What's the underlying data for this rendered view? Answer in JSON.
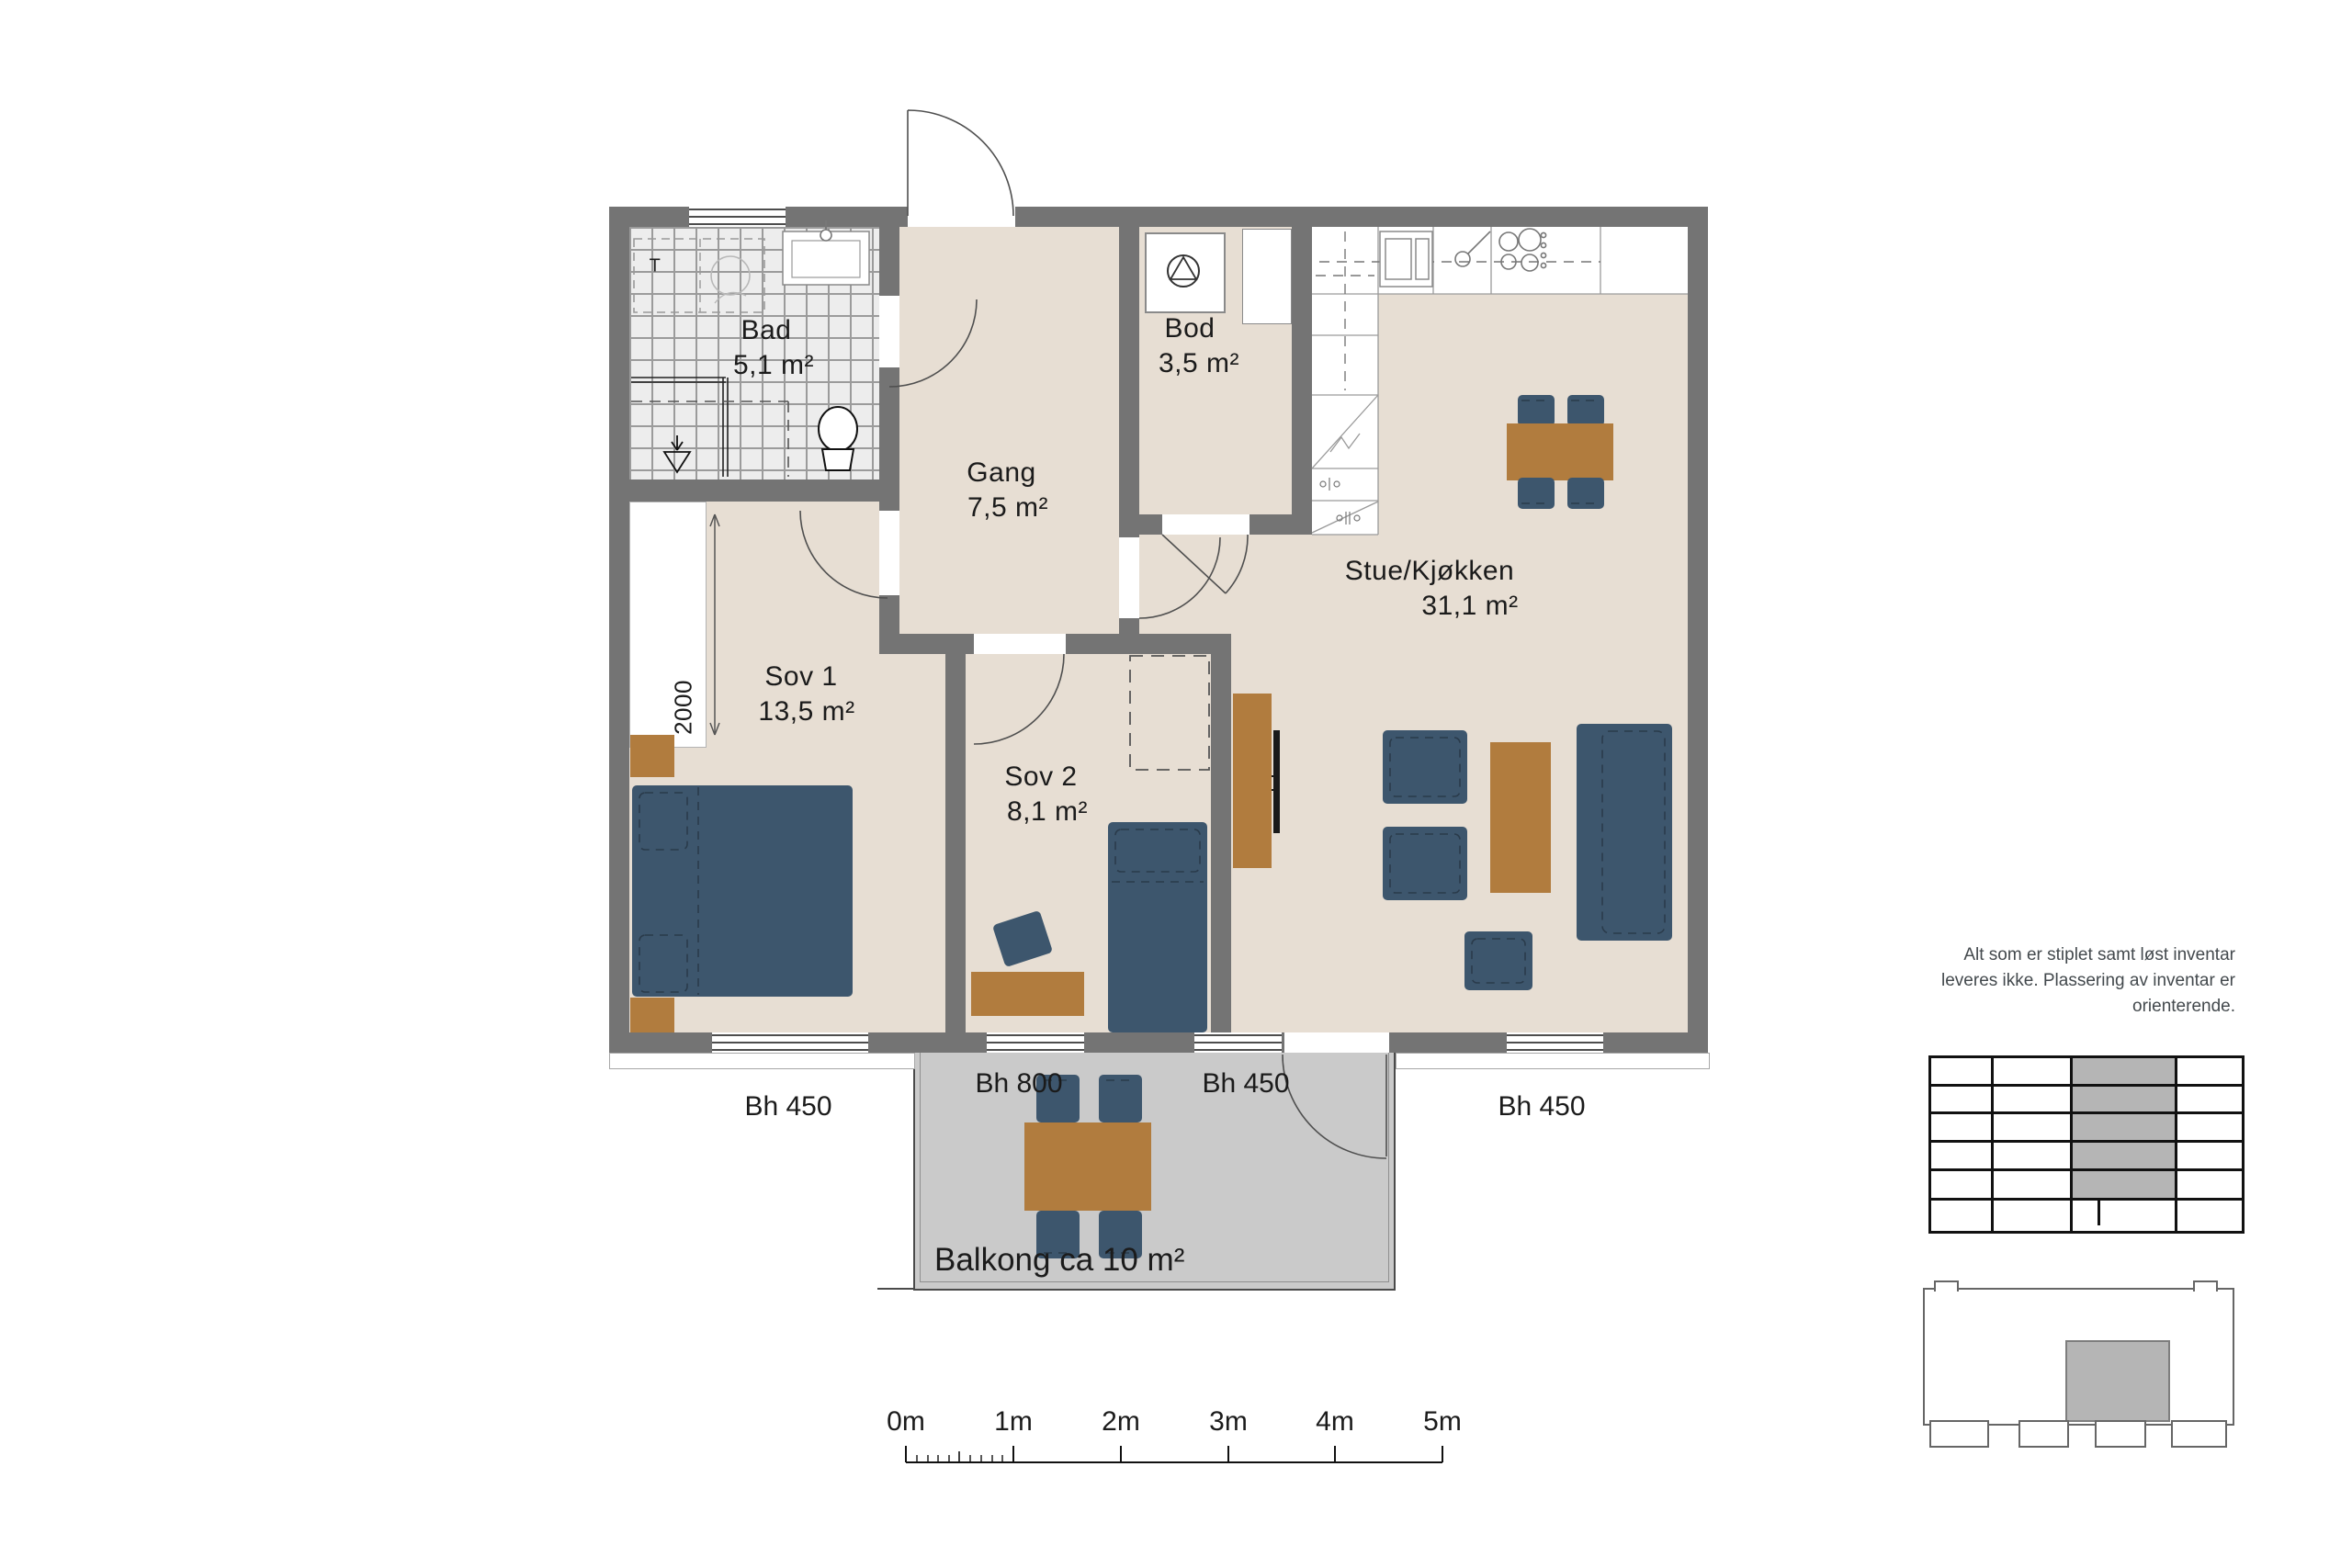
{
  "colors": {
    "wall": "#747474",
    "floor": "#e7ded3",
    "tile": "#ededed",
    "furniture_blue": "#3d566d",
    "furniture_brown": "#b17c3e",
    "balcony_slab": "#cacaca",
    "key_highlight": "#b5b5b5"
  },
  "rooms": {
    "bad": {
      "name": "Bad",
      "area": "5,1 m²"
    },
    "gang": {
      "name": "Gang",
      "area": "7,5 m²"
    },
    "bod": {
      "name": "Bod",
      "area": "3,5 m²"
    },
    "stue": {
      "name": "Stue/Kjøkken",
      "area": "31,1 m²"
    },
    "sov1": {
      "name": "Sov 1",
      "area": "13,5 m²"
    },
    "sov2": {
      "name": "Sov 2",
      "area": "8,1 m²"
    }
  },
  "balcony": {
    "label": "Balkong ca 10 m²"
  },
  "window_labels": [
    "Bh 450",
    "Bh 800",
    "Bh 450",
    "Bh 450"
  ],
  "annotations": {
    "washer": "T",
    "closet_dim": "2000",
    "note_lines": [
      "Alt som er stiplet samt løst inventar",
      "leveres ikke. Plassering av inventar er",
      "orienterende."
    ]
  },
  "scalebar": {
    "labels": [
      "0m",
      "1m",
      "2m",
      "3m",
      "4m",
      "5m"
    ]
  }
}
